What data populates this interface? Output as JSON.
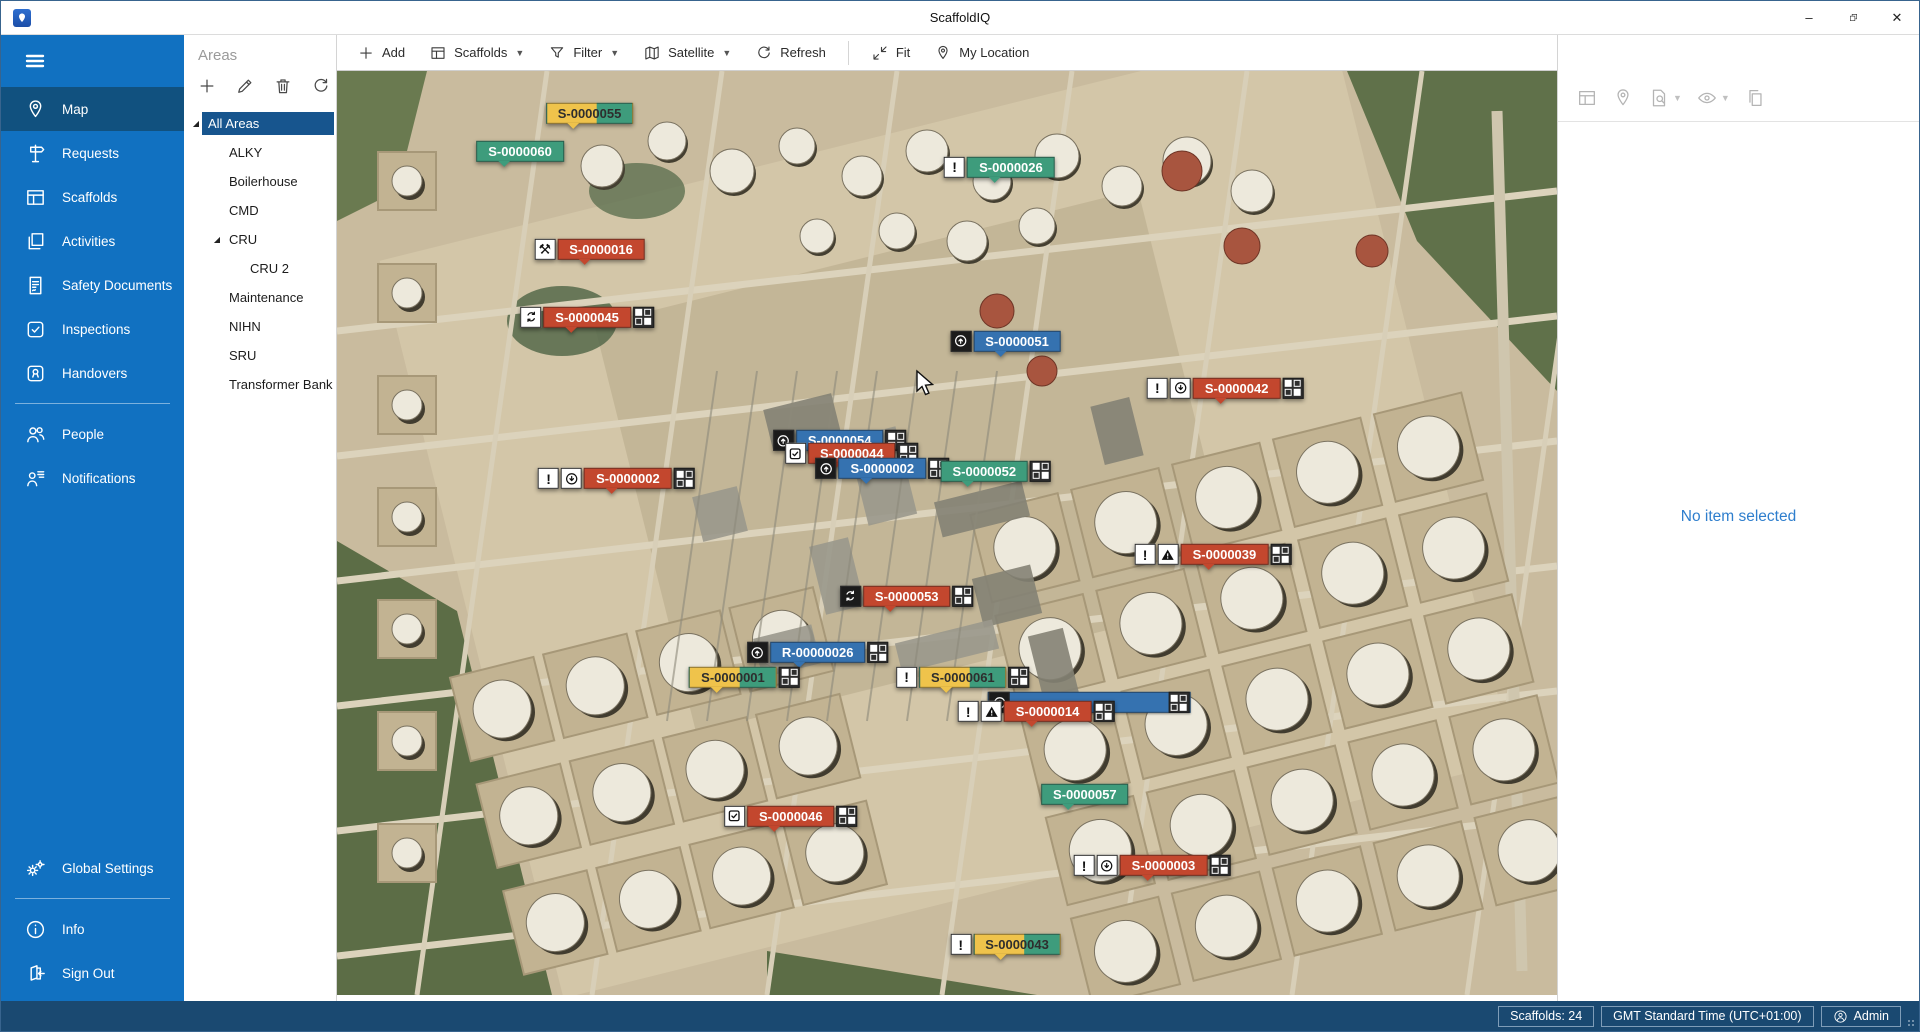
{
  "titlebar": {
    "title": "ScaffoldIQ",
    "minimize": "–",
    "restore": "restore",
    "close": "✕"
  },
  "sidebar": {
    "items": [
      {
        "label": "Map",
        "icon": "map-pin",
        "selected": true
      },
      {
        "label": "Requests",
        "icon": "signpost"
      },
      {
        "label": "Scaffolds",
        "icon": "scaffold"
      },
      {
        "label": "Activities",
        "icon": "stack"
      },
      {
        "label": "Safety Documents",
        "icon": "document"
      },
      {
        "label": "Inspections",
        "icon": "check-square"
      },
      {
        "label": "Handovers",
        "icon": "badge"
      },
      {
        "type": "divider"
      },
      {
        "label": "People",
        "icon": "people"
      },
      {
        "label": "Notifications",
        "icon": "person-note"
      }
    ],
    "footer_items": [
      {
        "label": "Global Settings",
        "icon": "gears"
      },
      {
        "type": "divider"
      },
      {
        "label": "Info",
        "icon": "info"
      },
      {
        "label": "Sign Out",
        "icon": "sign-out"
      }
    ]
  },
  "areas_panel": {
    "title": "Areas",
    "tools": [
      {
        "name": "add",
        "icon": "plus"
      },
      {
        "name": "edit",
        "icon": "pencil"
      },
      {
        "name": "delete",
        "icon": "trash"
      },
      {
        "name": "refresh",
        "icon": "refresh"
      }
    ],
    "tree": [
      {
        "label": "All Areas",
        "level": 0,
        "expanded": true,
        "selected": true
      },
      {
        "label": "ALKY",
        "level": 1
      },
      {
        "label": "Boilerhouse",
        "level": 1
      },
      {
        "label": "CMD",
        "level": 1
      },
      {
        "label": "CRU",
        "level": 1,
        "expanded": true
      },
      {
        "label": "CRU 2",
        "level": 2
      },
      {
        "label": "Maintenance",
        "level": 1
      },
      {
        "label": "NIHN",
        "level": 1
      },
      {
        "label": "SRU",
        "level": 1
      },
      {
        "label": "Transformer Bank",
        "level": 1
      }
    ]
  },
  "map_toolbar": {
    "buttons": [
      {
        "label": "Add",
        "icon": "plus"
      },
      {
        "label": "Scaffolds",
        "icon": "scaffold",
        "dropdown": true
      },
      {
        "label": "Filter",
        "icon": "funnel",
        "dropdown": true
      },
      {
        "label": "Satellite",
        "icon": "map",
        "dropdown": true
      },
      {
        "label": "Refresh",
        "icon": "refresh"
      },
      {
        "type": "separator"
      },
      {
        "label": "Fit",
        "icon": "fit"
      },
      {
        "label": "My Location",
        "icon": "map-pin"
      }
    ]
  },
  "right_panel": {
    "tools": [
      {
        "name": "scaffold-details",
        "icon": "scaffold"
      },
      {
        "name": "locate",
        "icon": "map-pin"
      },
      {
        "name": "document-search",
        "icon": "doc-search",
        "dropdown": true
      },
      {
        "name": "visibility",
        "icon": "eye",
        "dropdown": true
      },
      {
        "name": "copy",
        "icon": "copy"
      }
    ],
    "empty_text": "No item selected"
  },
  "status_bar": {
    "scaffolds_label": "Scaffolds: 24",
    "timezone_label": "GMT Standard Time (UTC+01:00)",
    "user_label": "Admin"
  },
  "colors": {
    "tag_red": "#C3472E",
    "tag_green": "#3E9C7C",
    "tag_blue": "#3572B0",
    "tag_yellow": "#EFC34B",
    "sidebar": "#1171C1",
    "sidebar_selected": "#11517F",
    "tree_selected": "#17558E",
    "status_bar": "#1A4971",
    "empty_text_blue": "#2E7ECD"
  },
  "map": {
    "tags": [
      {
        "label": "S-0000055",
        "style": "split",
        "x": 20.7,
        "y": 4.8,
        "icons": [],
        "grid": false
      },
      {
        "label": "S-0000060",
        "style": "green",
        "x": 15.0,
        "y": 8.9,
        "icons": [],
        "grid": false
      },
      {
        "label": "S-0000026",
        "style": "green",
        "x": 54.3,
        "y": 10.6,
        "icons": [
          {
            "type": "alert"
          }
        ],
        "grid": false
      },
      {
        "label": "S-0000016",
        "style": "red",
        "x": 20.7,
        "y": 19.5,
        "icons": [
          {
            "type": "tools"
          }
        ],
        "grid": false
      },
      {
        "label": "S-0000045",
        "style": "red",
        "x": 20.5,
        "y": 26.8,
        "icons": [
          {
            "type": "sync"
          }
        ],
        "grid": true
      },
      {
        "label": "S-0000051",
        "style": "blue",
        "x": 54.8,
        "y": 29.4,
        "icons": [
          {
            "type": "arrow-up",
            "dark": true
          }
        ],
        "grid": false
      },
      {
        "label": "S-0000042",
        "style": "red",
        "x": 72.8,
        "y": 34.5,
        "icons": [
          {
            "type": "alert"
          },
          {
            "type": "arrow-down"
          }
        ],
        "grid": true
      },
      {
        "label": "S-0000054",
        "style": "blue",
        "x": 41.2,
        "y": 40.2,
        "icons": [
          {
            "type": "arrow-up",
            "dark": true
          }
        ],
        "grid": true
      },
      {
        "label": "S-0000044",
        "style": "red",
        "x": 42.2,
        "y": 41.6,
        "icons": [
          {
            "type": "check"
          }
        ],
        "grid": true
      },
      {
        "label": "S-0000002",
        "style": "blue",
        "x": 44.7,
        "y": 43.2,
        "icons": [
          {
            "type": "arrow-up",
            "dark": true
          }
        ],
        "grid": true
      },
      {
        "label": "S-0000052",
        "style": "green",
        "x": 54.0,
        "y": 43.5,
        "icons": [],
        "grid": true
      },
      {
        "label": "S-0000002",
        "style": "red",
        "x": 22.9,
        "y": 44.3,
        "icons": [
          {
            "type": "alert"
          },
          {
            "type": "arrow-down"
          }
        ],
        "grid": true
      },
      {
        "label": "S-0000039",
        "style": "red",
        "x": 71.8,
        "y": 52.5,
        "icons": [
          {
            "type": "alert"
          },
          {
            "type": "warning"
          }
        ],
        "grid": true
      },
      {
        "label": "S-0000053",
        "style": "red",
        "x": 46.7,
        "y": 57.0,
        "icons": [
          {
            "type": "sync",
            "dark": true
          }
        ],
        "grid": true
      },
      {
        "label": "R-00000026",
        "style": "blue",
        "x": 39.4,
        "y": 63.1,
        "icons": [
          {
            "type": "arrow-up",
            "dark": true
          }
        ],
        "grid": true
      },
      {
        "label": "S-0000001",
        "style": "split",
        "x": 33.4,
        "y": 65.8,
        "icons": [],
        "grid": true
      },
      {
        "label": "S-0000061",
        "style": "split",
        "x": 51.3,
        "y": 65.8,
        "icons": [
          {
            "type": "alert"
          }
        ],
        "grid": true
      },
      {
        "label": "S-0000014",
        "style": "red",
        "x": 57.3,
        "y": 69.5,
        "icons": [
          {
            "type": "alert"
          },
          {
            "type": "warning"
          }
        ],
        "grid": true,
        "underlay": true
      },
      {
        "label": "S-0000057",
        "style": "green",
        "x": 61.3,
        "y": 78.5,
        "icons": [],
        "grid": false
      },
      {
        "label": "S-0000046",
        "style": "red",
        "x": 37.2,
        "y": 80.8,
        "icons": [
          {
            "type": "check"
          }
        ],
        "grid": true
      },
      {
        "label": "S-0000003",
        "style": "red",
        "x": 66.8,
        "y": 86.2,
        "icons": [
          {
            "type": "alert"
          },
          {
            "type": "arrow-down"
          }
        ],
        "grid": true
      },
      {
        "label": "S-0000043",
        "style": "split",
        "x": 54.8,
        "y": 94.7,
        "icons": [
          {
            "type": "alert"
          }
        ],
        "grid": false
      }
    ],
    "cursor": {
      "x": 47.2,
      "y": 32.2
    }
  }
}
